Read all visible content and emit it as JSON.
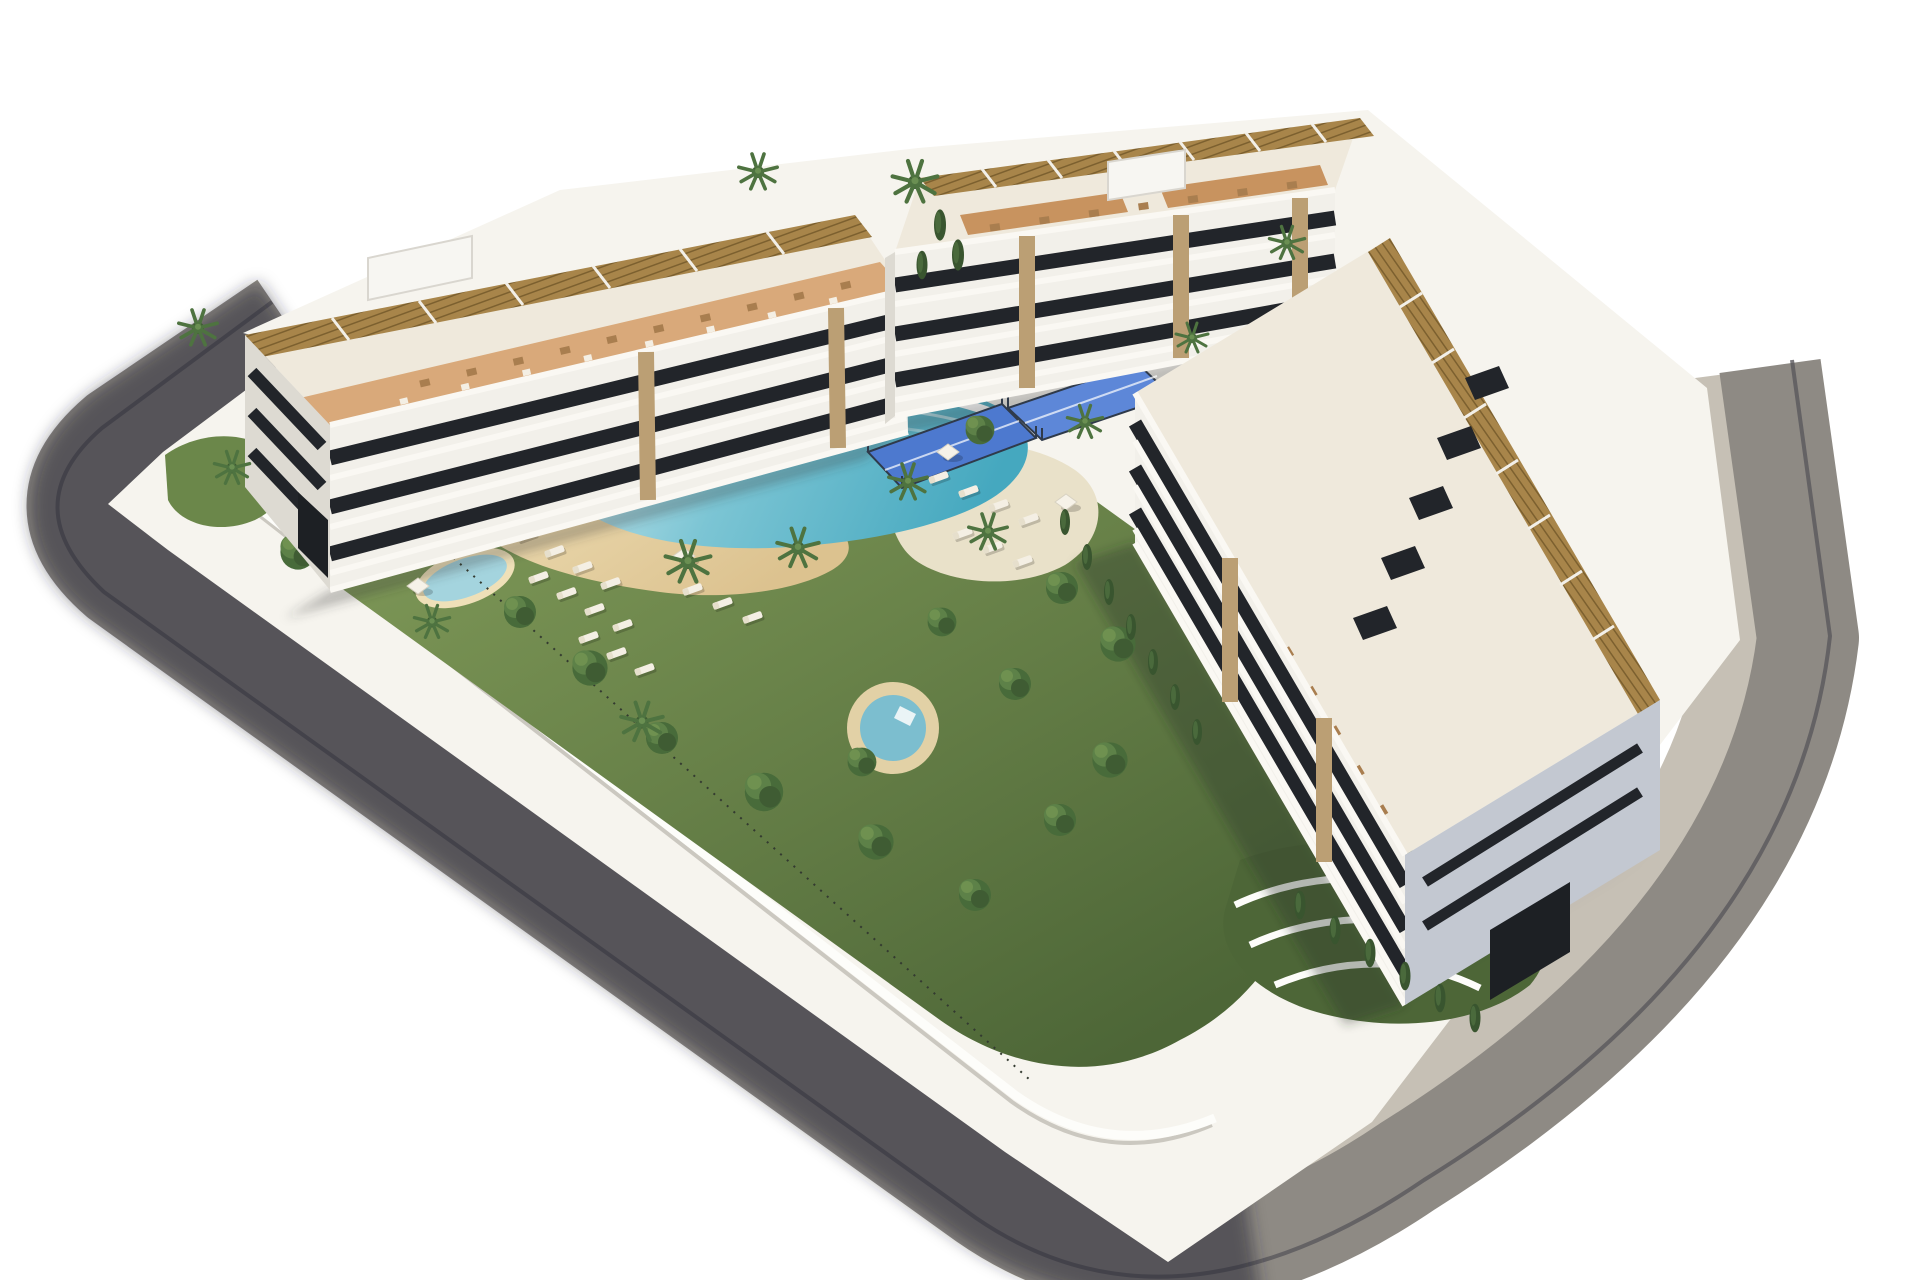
{
  "meta": {
    "image_type": "3d-architectural-render",
    "description": "Aerial 3D rendering of a modern Mediterranean residential apartment complex: three white apartment blocks with rooftop pergola terraces around a landscaped courtyard with a lagoon-style pool, beach deck, round plunge pool, kids pool, padel courts, palm trees and gardens, wrapped by a curved perimeter street on a plain white background",
    "width_px": 1920,
    "height_px": 1280,
    "background": "#ffffff"
  },
  "palette": {
    "road": "#8e8a84",
    "road_edge": "#5a575c",
    "road_shadow": "rgba(44,42,54,0.55)",
    "sidewalk": "#c6c0b5",
    "plot_base": "#f6f4ee",
    "wall_white": "#fdfdfa",
    "wall_shade": "#b9b5ad",
    "grass_light": "#8aa45f",
    "grass_mid": "#6b874a",
    "grass_dark": "#4d6637",
    "garden_shadow": "rgba(40,48,36,0.35)",
    "sand_light": "#efe0b8",
    "sand_dark": "#dcc28f",
    "pool_pale": "#d3ecf1",
    "pool_mid": "#7cc5d4",
    "pool_deep": "#45a8bf",
    "pool_wall": "#ffffff",
    "kids_pool": "#a4d4de",
    "round_pool_water": "#7cbecf",
    "round_pool_deck": "#e2d1a6",
    "deck_pale": "#e9e1c9",
    "padel_blue": "#4d79cf",
    "padel_blue2": "#5d87d8",
    "fence_dark": "#2f3a4a",
    "facade_white": "#f2f0ea",
    "facade_cream": "#efe9dc",
    "facade_shade": "#dddad2",
    "facade_blue": "#c3c8d1",
    "glazing": "#22252a",
    "slab_white": "#faf8f3",
    "stone_tan": "#bb9f74",
    "terracotta": "#d9a97a",
    "terracotta_deep": "#c8935f",
    "pergola": "#a8854a",
    "pergola_slat": "#7c602f",
    "furniture_brown": "#a97e4f",
    "furniture_white": "#f4efe4",
    "garage_dark": "#1d2024",
    "shadow_soft": "rgba(55,58,52,0.30)"
  },
  "icons": {
    "tree": "circle-cluster",
    "palm-tree": "radial-fronds",
    "cypress": "narrow-ellipse",
    "sun-lounger": "white-bar",
    "parasol": "diamond-canopy"
  },
  "elements": {
    "street": "curved perimeter asphalt street with light sidewalk and shadowed south-west side",
    "plot": "rounded building plot platform with white boundary walls",
    "left_block": "4-storey apartment block, roof pergolas and terracotta terraces, white end facade with ribbon windows and garage",
    "back_block": "4-storey apartment block with glass balconies, stone columns and tiled roof terraces",
    "right_block": "long 4-storey block with rooftop pergola row, skylights, terrace gardens and shaded end facade",
    "lagoon_pool": "organic lagoon-style swimming pool with white wave wall and beach entry",
    "beach_deck": "sand-coloured beach deck beside the lagoon pool",
    "kids_pool": "small kidney-shaped children's pool",
    "round_pool": "circular plunge pool with tan deck ring",
    "padel_courts": "two blue padel courts below the back block",
    "gardens": "lawns, palm trees, cypresses and walled terrace gardens",
    "furniture": "white sun loungers and parasols on the lawns"
  }
}
